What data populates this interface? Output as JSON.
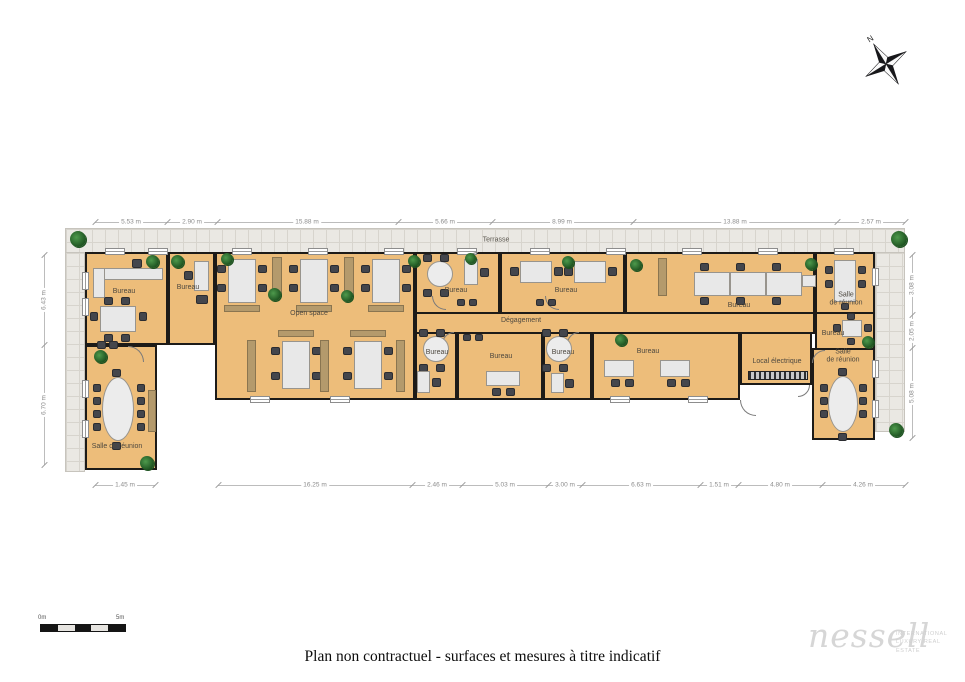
{
  "page": {
    "caption": "Plan non contractuel - surfaces et mesures à titre indicatif",
    "compass_label": "N",
    "scale": {
      "left_label": "0m",
      "right_label": "5m"
    },
    "logo": {
      "brand": "nessell",
      "tagline_line1": "INTERNATIONAL",
      "tagline_line2": "LUXURY REAL ESTATE"
    }
  },
  "plan": {
    "terrace_label": {
      "text": "Terrasse",
      "x": 496,
      "y": 240
    },
    "room_labels": [
      {
        "text": "Bureau",
        "x": 124,
        "y": 292
      },
      {
        "text": "Bureau",
        "x": 188,
        "y": 288
      },
      {
        "text": "Open space",
        "x": 309,
        "y": 314
      },
      {
        "text": "Bureau",
        "x": 456,
        "y": 291
      },
      {
        "text": "Bureau",
        "x": 566,
        "y": 291
      },
      {
        "text": "Dégagement",
        "x": 521,
        "y": 321
      },
      {
        "text": "Bureau",
        "x": 437,
        "y": 353
      },
      {
        "text": "Bureau",
        "x": 501,
        "y": 357
      },
      {
        "text": "Bureau",
        "x": 563,
        "y": 353
      },
      {
        "text": "Bureau",
        "x": 648,
        "y": 352
      },
      {
        "text": "Bureau",
        "x": 739,
        "y": 306
      },
      {
        "text": "Salle\nde réunion",
        "x": 846,
        "y": 300
      },
      {
        "text": "Bureau",
        "x": 833,
        "y": 334
      },
      {
        "text": "Local électrique",
        "x": 777,
        "y": 362
      },
      {
        "text": "Salle\nde réunion",
        "x": 843,
        "y": 357
      },
      {
        "text": "Salle de réunion",
        "x": 117,
        "y": 447
      }
    ],
    "colors": {
      "floor": "#edbd7a",
      "wall": "#1d1b18",
      "terrace": "#eae8e3",
      "desk": "#e8e8e8",
      "chair": "#44464c",
      "cabinet": "#b49a6c",
      "plant": "#2e7032",
      "dimension": "#8c8c8c"
    }
  },
  "dimensions": {
    "top": [
      {
        "x": 131,
        "label": "5.53 m"
      },
      {
        "x": 192,
        "label": "2.90 m"
      },
      {
        "x": 307,
        "label": "15.88 m"
      },
      {
        "x": 445,
        "label": "5.66 m"
      },
      {
        "x": 562,
        "label": "8.99 m"
      },
      {
        "x": 735,
        "label": "13.88 m"
      },
      {
        "x": 871,
        "label": "2.57 m"
      }
    ],
    "bottom": [
      {
        "x": 125,
        "label": "1.45 m"
      },
      {
        "x": 315,
        "label": "16.25 m"
      },
      {
        "x": 437,
        "label": "2.46 m"
      },
      {
        "x": 505,
        "label": "5.03 m"
      },
      {
        "x": 565,
        "label": "3.00 m"
      },
      {
        "x": 641,
        "label": "6.63 m"
      },
      {
        "x": 719,
        "label": "1.51 m"
      },
      {
        "x": 780,
        "label": "4.80 m"
      },
      {
        "x": 863,
        "label": "4.26 m"
      }
    ],
    "left": [
      {
        "y": 300,
        "label": "6.43 m"
      },
      {
        "y": 405,
        "label": "6.70 m"
      }
    ],
    "right": [
      {
        "y": 285,
        "label": "3.08 m"
      },
      {
        "y": 331,
        "label": "2.05 m"
      },
      {
        "y": 393,
        "label": "5.08 m"
      }
    ]
  }
}
